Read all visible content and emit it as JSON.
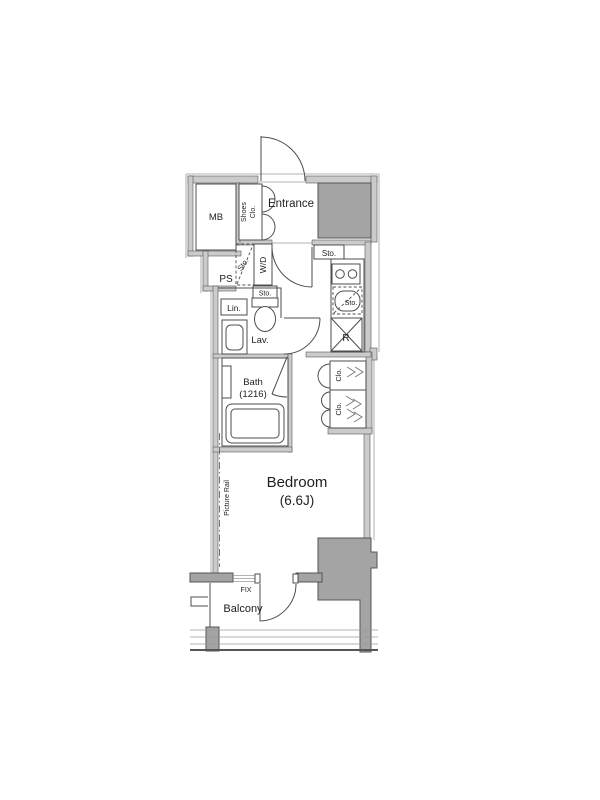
{
  "plan": {
    "labels": {
      "mb": "MB",
      "shoes_line1": "Shoes",
      "shoes_line2": "Clo.",
      "entrance": "Entrance",
      "sto_hall": "Sto.",
      "sto_wd": "Sto.",
      "wd": "W/D",
      "ps": "PS",
      "sto_toilet": "Sto.",
      "lin": "Lin.",
      "lav": "Lav.",
      "sto_kitchen": "Sto.",
      "fridge": "R",
      "bath_line1": "Bath",
      "bath_line2": "(1216)",
      "clo_upper": "Clo.",
      "clo_lower": "Clo.",
      "bedroom_line1": "Bedroom",
      "bedroom_line2": "(6.6J)",
      "picture_rail": "Picture Rail",
      "fix": "FIX",
      "balcony": "Balcony"
    },
    "colors": {
      "wall_fill": "#cbcbcb",
      "mass_fill": "#a4a4a4",
      "line": "#4d4d4d"
    }
  }
}
